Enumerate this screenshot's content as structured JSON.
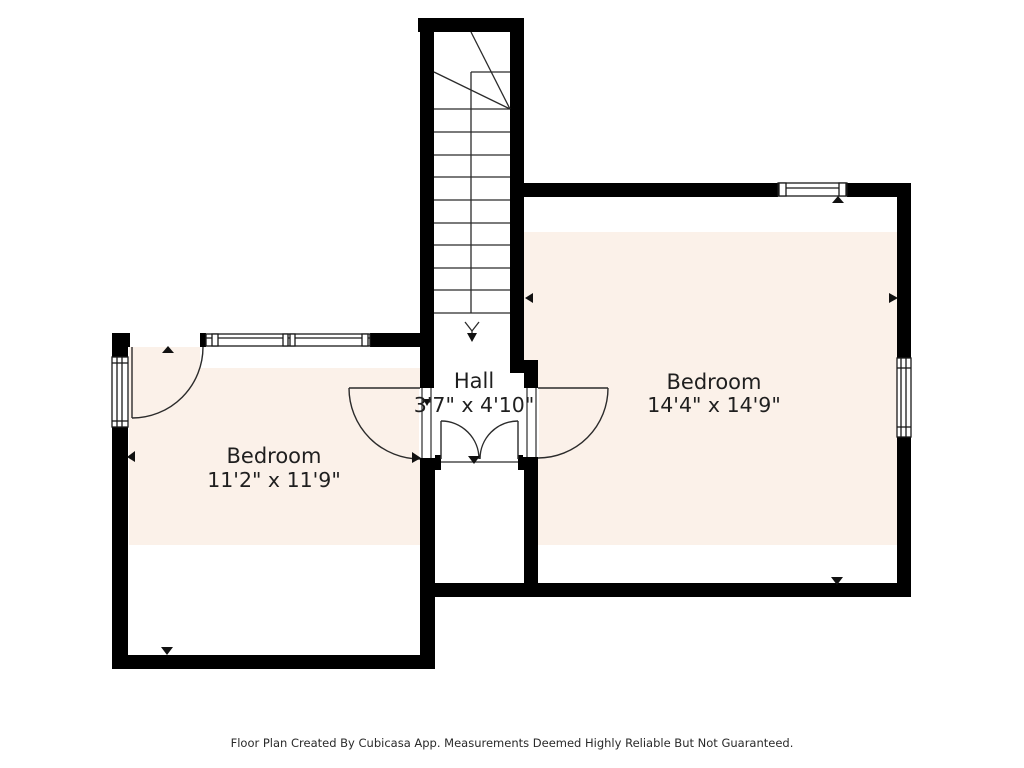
{
  "floor_plan": {
    "rooms": {
      "hall": {
        "name": "Hall",
        "dimensions": "3'7\" x 4'10\""
      },
      "bedroom_right": {
        "name": "Bedroom",
        "dimensions": "14'4\" x 14'9\""
      },
      "bedroom_left": {
        "name": "Bedroom",
        "dimensions": "11'2\" x 11'9\""
      }
    },
    "stairs": {
      "direction_note": "down-arrow"
    },
    "footer": "Floor Plan Created By Cubicasa App. Measurements Deemed Highly Reliable But Not Guaranteed.",
    "colors": {
      "background": "#ffffff",
      "wall": "#000000",
      "floor_fill": "#fbf1e9",
      "line": "#2b2b2b",
      "text": "#1f1f1f"
    }
  }
}
